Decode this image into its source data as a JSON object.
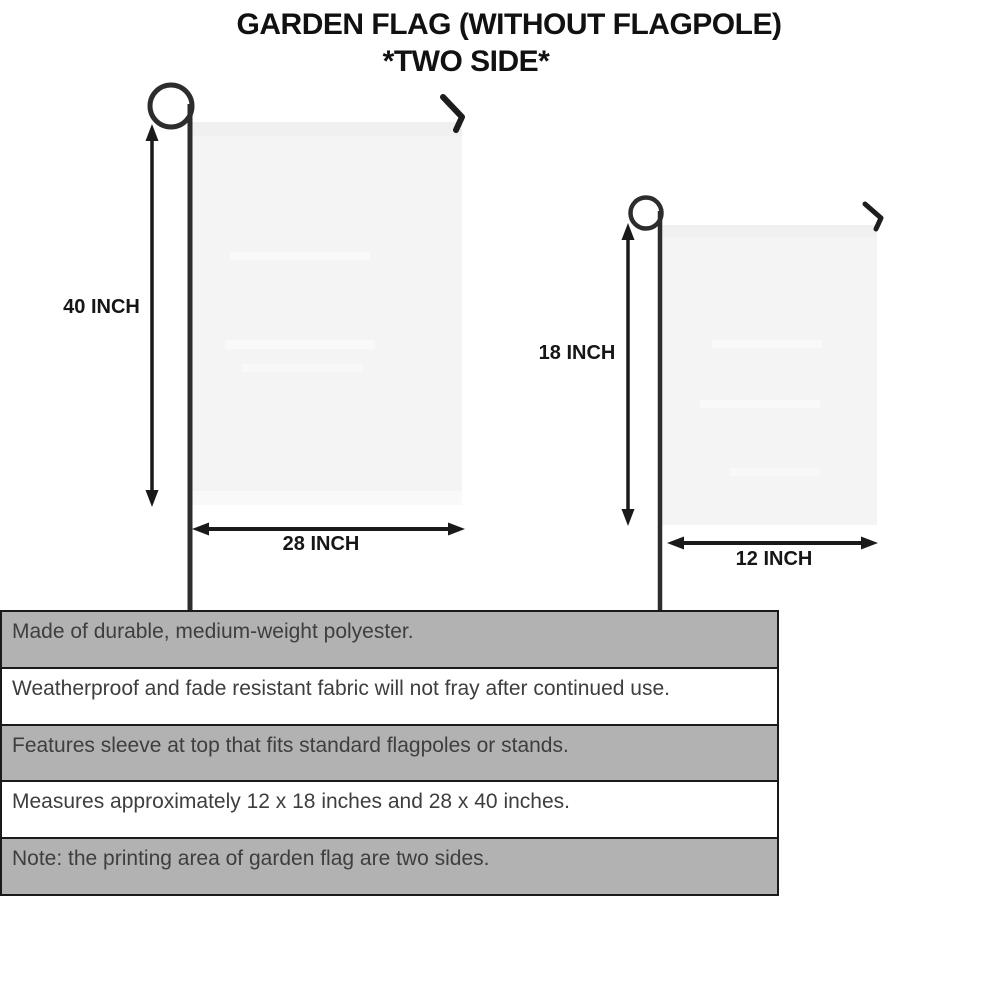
{
  "title": {
    "line1": "GARDEN FLAG (WITHOUT FLAGPOLE)",
    "line2": "*TWO SIDE*"
  },
  "diagram": {
    "large_flag": {
      "height_label": "40 INCH",
      "width_label": "28 INCH"
    },
    "small_flag": {
      "height_label": "18 INCH",
      "width_label": "12 INCH"
    }
  },
  "specs": {
    "rows": [
      "Made of durable, medium-weight polyester.",
      "Weatherproof and fade resistant fabric will not fray after continued use.",
      "Features sleeve at top that fits standard flagpoles or stands.",
      "Measures approximately 12 x 18 inches and 28 x 40 inches.",
      "Note: the printing area of garden flag are two sides."
    ]
  },
  "colors": {
    "row_gray": "#b2b2b2",
    "flag_fill": "#f4f4f5",
    "pole": "#2d2d2d",
    "arrow_ink": "#1a1a1a",
    "spec_text": "#3e3e3e"
  }
}
